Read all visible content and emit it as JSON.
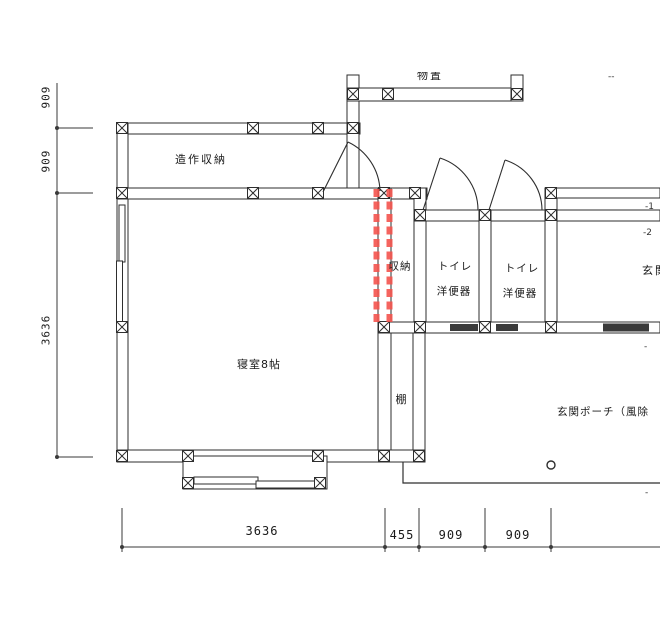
{
  "dimensions": {
    "left_top": "909",
    "left_mid": "909",
    "left_main": "3636",
    "bottom_main": "3636",
    "bottom_a": "455",
    "bottom_b": "909",
    "bottom_c": "909"
  },
  "rooms": {
    "closet": "造作収納",
    "storage": "収納",
    "toilet1_name": "トイレ",
    "toilet1_fixture": "洋便器",
    "toilet2_name": "トイレ",
    "toilet2_fixture": "洋便器",
    "entrance": "玄関",
    "bedroom": "寝室8帖",
    "shelf": "棚",
    "porch": "玄関ポーチ（風除",
    "upper_partial": "物置"
  },
  "fragments": {
    "top_right": "--",
    "right_upper": "-1",
    "right_lower": "-2",
    "right_mid": "-",
    "bottom_right": "-"
  },
  "colors": {
    "highlight": "#f4544e",
    "line": "#2e2e2e"
  }
}
